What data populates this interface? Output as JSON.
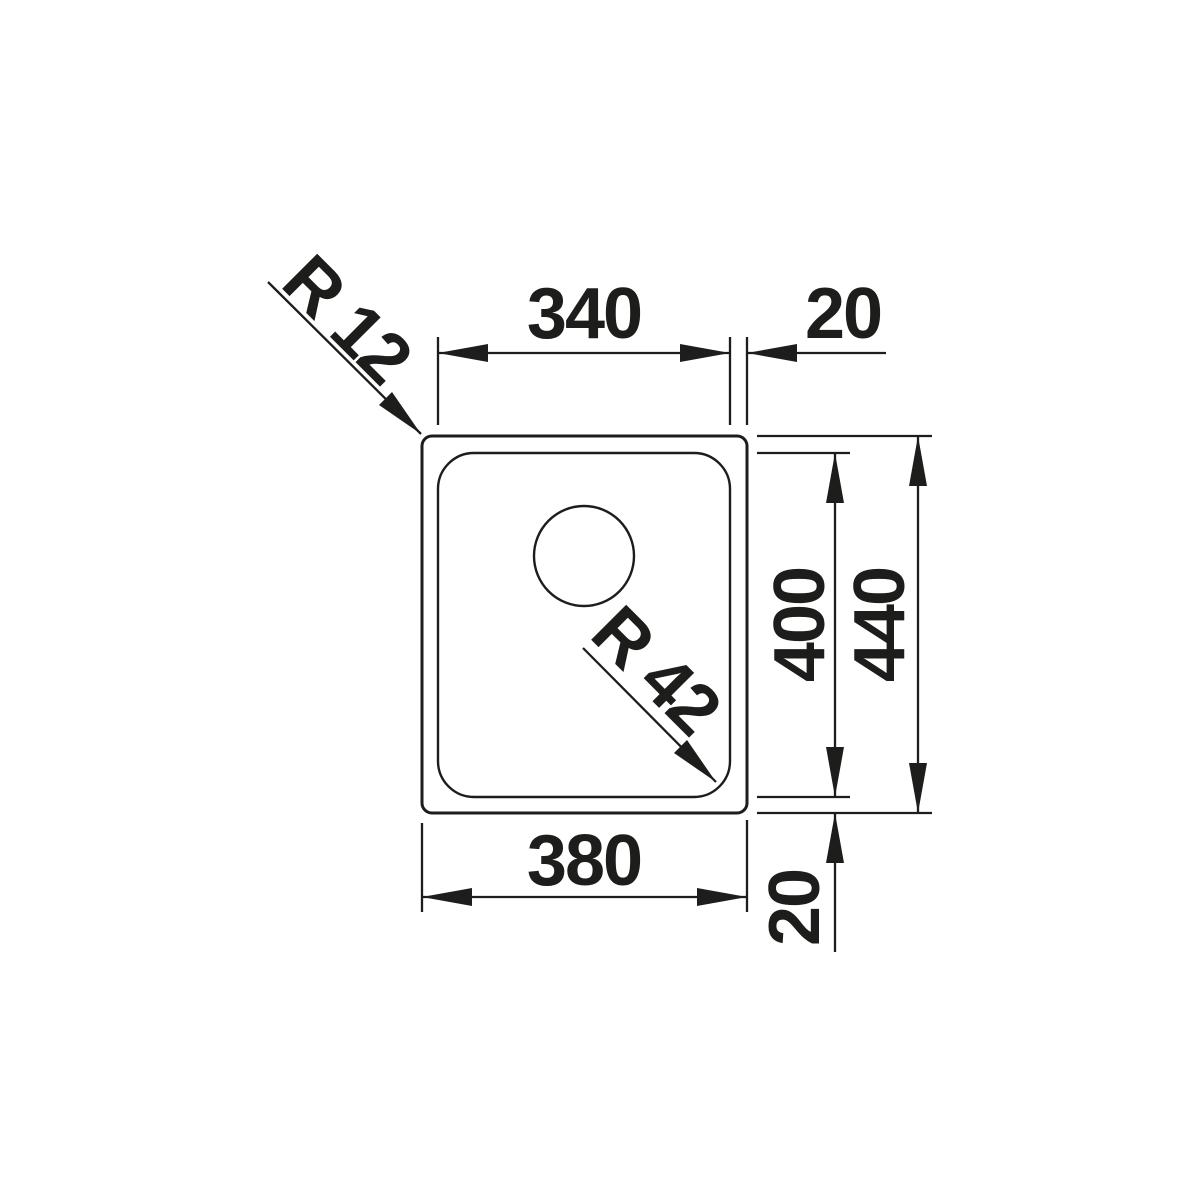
{
  "drawing": {
    "type": "sink-dimension-drawing",
    "labels": {
      "inner_width": "340",
      "rim_offset_right": "20",
      "inner_height": "400",
      "outer_height": "440",
      "outer_width": "380",
      "rim_offset_bottom": "20",
      "outer_corner_radius": "R 12",
      "bowl_corner_radius": "R 42"
    },
    "colors": {
      "line": "#1d1d1b",
      "background": "#ffffff"
    }
  }
}
